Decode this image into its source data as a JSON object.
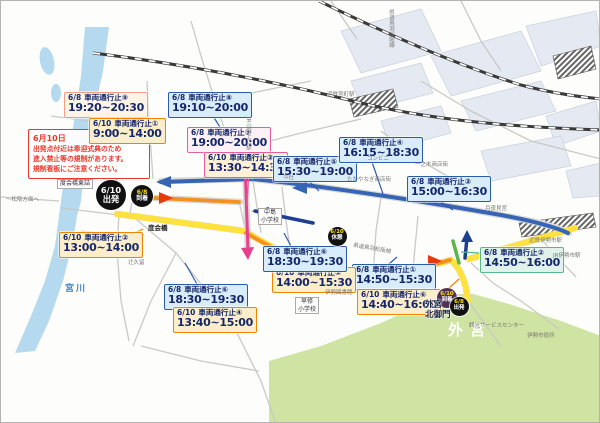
{
  "map": {
    "area_name": "伊勢市 外宮周辺 交通規制マップ"
  },
  "notice": {
    "title": "6月10日",
    "lines": [
      "出発点付近は奉迎式典のため",
      "進入禁止等の規制があります。",
      "規制看板にご注意ください。"
    ]
  },
  "closures": [
    {
      "date": "6/8",
      "label": "車両通行止⑨",
      "time": "19:20~20:30",
      "x": 63,
      "y": 91,
      "style": "salmon"
    },
    {
      "date": "6/10",
      "label": "車両通行止①",
      "time": "9:00~14:00",
      "x": 88,
      "y": 117,
      "style": "orange"
    },
    {
      "date": "6/8",
      "label": "車両通行止⑧",
      "time": "19:10~20:00",
      "x": 167,
      "y": 91,
      "style": "blue"
    },
    {
      "date": "6/8",
      "label": "車両通行止⑦",
      "time": "19:00~20:00",
      "x": 186,
      "y": 126,
      "style": "pink"
    },
    {
      "date": "6/10",
      "label": "車両通行止③",
      "time": "13:30~14:30",
      "x": 203,
      "y": 151,
      "style": "pinkcream"
    },
    {
      "date": "6/8",
      "label": "車両通行止⑤",
      "time": "15:30~19:00",
      "x": 272,
      "y": 155,
      "style": "blue"
    },
    {
      "date": "6/8",
      "label": "車両通行止④",
      "time": "16:15~18:30",
      "x": 338,
      "y": 136,
      "style": "blue"
    },
    {
      "date": "6/8",
      "label": "車両通行止③",
      "time": "15:00~16:30",
      "x": 406,
      "y": 175,
      "style": "blue"
    },
    {
      "date": "6/8",
      "label": "車両通行止②",
      "time": "14:50~16:00",
      "x": 479,
      "y": 246,
      "style": "green"
    },
    {
      "date": "6/8",
      "label": "車両通行止①",
      "time": "14:50~15:30",
      "x": 351,
      "y": 263,
      "style": "blue"
    },
    {
      "date": "6/10",
      "label": "車両通行止⑥",
      "time": "14:40~16:00",
      "x": 356,
      "y": 288,
      "style": "orange"
    },
    {
      "date": "6/10",
      "label": "車両通行止⑤",
      "time": "14:00~15:30",
      "x": 271,
      "y": 266,
      "style": "orange"
    },
    {
      "date": "6/8",
      "label": "車両通行止⑥",
      "time": "18:30~19:30",
      "x": 262,
      "y": 245,
      "style": "blue"
    },
    {
      "date": "6/10",
      "label": "車両通行止②",
      "time": "13:00~14:00",
      "x": 58,
      "y": 231,
      "style": "orange"
    },
    {
      "date": "6/8",
      "label": "車両通行止⑥",
      "time": "18:30~19:30",
      "x": 163,
      "y": 283,
      "style": "blue"
    },
    {
      "date": "6/10",
      "label": "車両通行止④",
      "time": "13:40~15:00",
      "x": 172,
      "y": 306,
      "style": "orange"
    }
  ],
  "markers": [
    {
      "name": "marker-departure-6-10",
      "line1": "6/10",
      "line2": "出発",
      "x": 110,
      "y": 194,
      "r": 15,
      "bg": "#111111",
      "c1": "#ffffff",
      "c2": "#ffffff"
    },
    {
      "name": "marker-arrival-6-8",
      "line1": "6/8",
      "line2": "到着",
      "x": 141,
      "y": 195,
      "r": 11,
      "bg": "#111111",
      "c1": "#ffe100",
      "c2": "#ffffff"
    },
    {
      "name": "marker-rest-6-10",
      "line1": "6/10",
      "line2": "休憩",
      "x": 336,
      "y": 235,
      "r": 9.5,
      "bg": "#111111",
      "c1": "#ffe100",
      "c2": "#ffffff"
    },
    {
      "name": "marker-arrival-6-10",
      "line1": "6/10",
      "line2": "到着",
      "x": 446,
      "y": 297,
      "r": 10,
      "bg": "#503055",
      "c1": "#ffe100",
      "c2": "#ffffff"
    },
    {
      "name": "marker-departure-6-8",
      "line1": "6/8",
      "line2": "出発",
      "x": 458,
      "y": 305,
      "r": 9.5,
      "bg": "#111111",
      "c1": "#ffe100",
      "c2": "#ffffff"
    }
  ],
  "places": [
    {
      "text": "宮川",
      "x": 64,
      "y": 280,
      "cls": "water"
    },
    {
      "text": "度会橋",
      "x": 147,
      "y": 221,
      "cls": "plain"
    },
    {
      "text": "度会橋東詰",
      "x": 56,
      "y": 178,
      "cls": "tag"
    },
    {
      "text": "～松阪方面へ",
      "x": 5,
      "y": 194,
      "cls": "tiny"
    },
    {
      "text": "外宮\n北御門",
      "x": 424,
      "y": 300,
      "cls": "gate"
    },
    {
      "text": "外宮",
      "x": 447,
      "y": 318,
      "cls": "geku"
    },
    {
      "text": "早修\n小学校",
      "x": 294,
      "y": 296,
      "cls": "tag"
    },
    {
      "text": "中島\n小学校",
      "x": 257,
      "y": 207,
      "cls": "tag"
    },
    {
      "text": "伊勢図書館",
      "x": 324,
      "y": 287,
      "cls": "tiny"
    },
    {
      "text": "今社",
      "x": 282,
      "y": 172,
      "cls": "tiny"
    },
    {
      "text": "コンビニ",
      "x": 366,
      "y": 153,
      "cls": "tiny"
    },
    {
      "text": "たかやなぎ商店街",
      "x": 346,
      "y": 174,
      "cls": "tiny"
    },
    {
      "text": "一之木商店街",
      "x": 414,
      "y": 159,
      "cls": "tiny"
    },
    {
      "text": "県道鳥羽松阪線",
      "x": 352,
      "y": 243,
      "cls": "tiny",
      "rot": 10
    },
    {
      "text": "県道鳥羽松阪線",
      "x": 386,
      "y": 8,
      "cls": "tiny vert"
    },
    {
      "text": "近鉄宮町駅",
      "x": 326,
      "y": 89,
      "cls": "tiny"
    },
    {
      "text": "JR山田上口駅",
      "x": 243,
      "y": 116,
      "cls": "tiny vert"
    },
    {
      "text": "近鉄伊勢市駅",
      "x": 528,
      "y": 235,
      "cls": "tiny"
    },
    {
      "text": "JR伊勢市駅",
      "x": 552,
      "y": 250,
      "cls": "tiny"
    },
    {
      "text": "伊勢市役所",
      "x": 526,
      "y": 330,
      "cls": "tiny"
    },
    {
      "text": "観光サービスセンター",
      "x": 468,
      "y": 320,
      "cls": "tiny"
    },
    {
      "text": "月夜見宮",
      "x": 484,
      "y": 203,
      "cls": "tiny"
    },
    {
      "text": "辻久留",
      "x": 127,
      "y": 257,
      "cls": "tiny"
    }
  ],
  "colors": {
    "route_6_8_blue": "#3565b4",
    "route_6_10_orange": "#f29122",
    "road_yellow": "#ffe23e",
    "pink": "#e4418f",
    "teal": "#2aa79e",
    "green": "#5cb54a",
    "arrow_red": "#e8380d",
    "navy": "#1d3f8f",
    "river": "#b5d9ee",
    "forest": "#cfe3a2",
    "notice_red": "#e8382c"
  }
}
